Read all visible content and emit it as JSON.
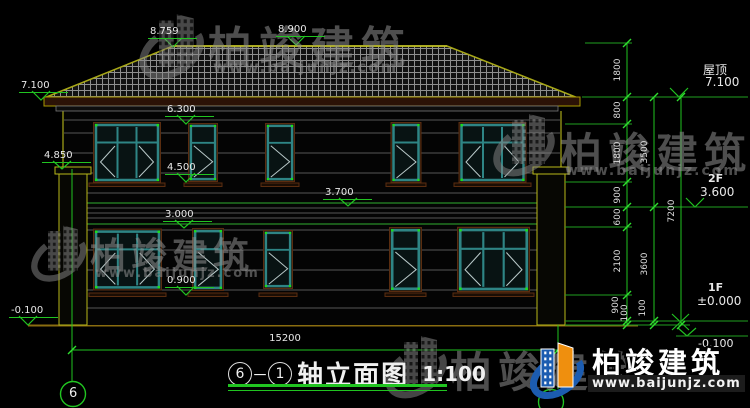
{
  "drawing": {
    "title": {
      "axis_from": "6",
      "axis_to": "1",
      "text": "轴立面图",
      "scale": "1:100"
    },
    "axis_bubble_left": "6",
    "levels_left": [
      "8.759",
      "8.900",
      "7.100",
      "6.300",
      "4.850",
      "4.500",
      "3.700",
      "3.000",
      "0.900",
      "-0.100"
    ],
    "levels_right": {
      "roof_label": "屋顶",
      "roof_value": "7.100",
      "f2_label": "2F",
      "f2_value": "3.600",
      "f1_label": "1F",
      "f1_value": "±0.000",
      "ground_value": "-0.100"
    },
    "dims": {
      "total_width": "15200",
      "col1": [
        "1800",
        "800",
        "1800",
        "900",
        "600",
        "2100",
        "900",
        "100"
      ],
      "col2": [
        "3500",
        "3600",
        "100"
      ],
      "col3": [
        "7200"
      ]
    }
  },
  "watermark": {
    "brand": "柏竣建筑",
    "url": "www.baijunjz.com"
  },
  "logo": {
    "brand": "柏竣建筑",
    "url": "www.baijunjz.com"
  },
  "colors": {
    "line_green": "#21c421",
    "roof_edge": "#a8a818",
    "window_frame": "#2e8585",
    "logo_blue": "#1c5cb0",
    "logo_orange": "#ef8f0e"
  }
}
